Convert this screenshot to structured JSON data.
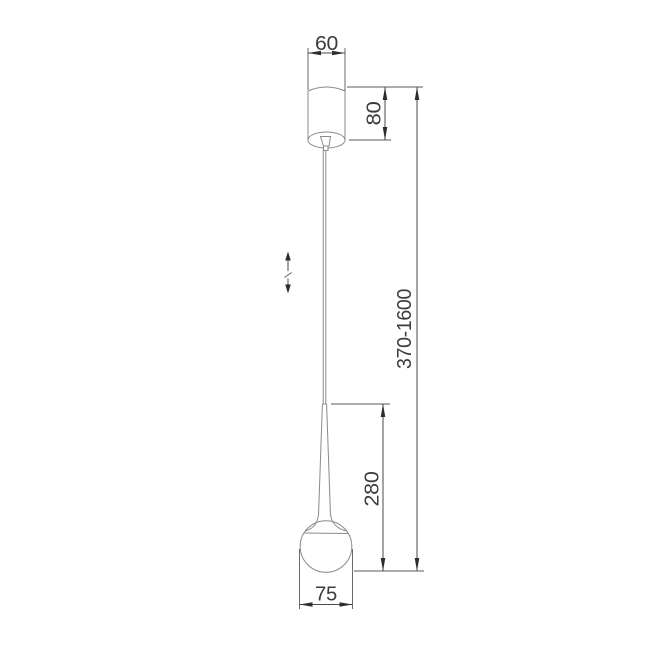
{
  "page": {
    "background_color": "#ffffff"
  },
  "drawing": {
    "subject": "pendant lamp with teardrop stem and ball diffuser - dimensioned technical line drawing",
    "colors": {
      "lamp_outline": "#8a8a8a",
      "dimension_lines": "#4a4a4a",
      "dimension_text": "#3c3c3c",
      "arrowheads": "#2e2e2e"
    },
    "dimensions": {
      "canopy_width": "60",
      "canopy_height": "80",
      "overall_drop_range": "370-1600",
      "lamp_body_height": "280",
      "sphere_diameter": "75"
    },
    "symbols": {
      "height_adjustable_icon": "double vertical arrow with slash (adjustable suspension height)"
    }
  }
}
